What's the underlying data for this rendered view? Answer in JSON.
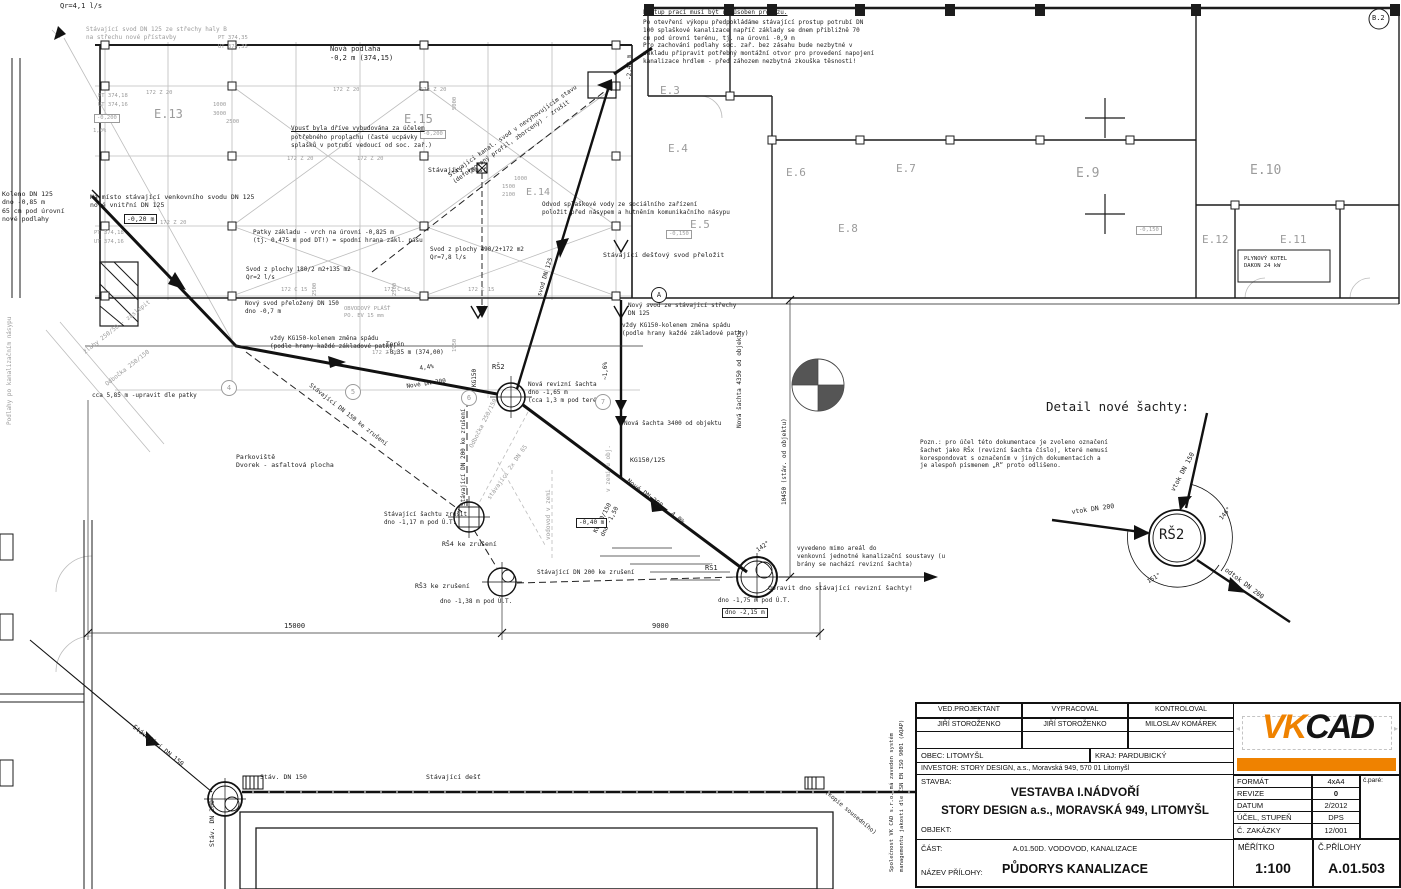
{
  "colors": {
    "ink": "#1c1c1c",
    "gray_line": "#bdbdbd",
    "gray_text": "#9b9b9b",
    "accent_orange": "#ef8200"
  },
  "title_block": {
    "col1_header": "VED.PROJEKTANT",
    "col1_value": "JIŘÍ STOROŽENKO",
    "col2_header": "VYPRACOVAL",
    "col2_value": "JIŘÍ STOROŽENKO",
    "col3_header": "KONTROLOVAL",
    "col3_value": "MILOSLAV KOMÁREK",
    "obec": "OBEC: LITOMYŠL",
    "kraj": "KRAJ: PARDUBICKÝ",
    "investor": "INVESTOR: STORY DESIGN, a.s., Moravská 949, 570 01 Litomyšl",
    "stavba_label": "STAVBA:",
    "stavba_line1": "VESTAVBA I.NÁDVOŘÍ",
    "stavba_line2": "STORY DESIGN a.s., MORAVSKÁ 949, LITOMYŠL",
    "objekt_label": "OBJEKT:",
    "cast_label": "ČÁST:",
    "cast_value": "A.01.50D. VODOVOD, KANALIZACE",
    "nazev_label": "NÁZEV PŘÍLOHY:",
    "nazev_value": "PŮDORYS KANALIZACE",
    "rows": [
      {
        "label": "FORMÁT",
        "value": "4xA4"
      },
      {
        "label": "REVIZE",
        "value": "0"
      },
      {
        "label": "DATUM",
        "value": "2/2012"
      },
      {
        "label": "ÚČEL, STUPEŇ",
        "value": "DPS"
      },
      {
        "label": "Č. ZAKÁZKY",
        "value": "12/001"
      }
    ],
    "pare_label": "č.paré:",
    "meritko_label": "MĚŘÍTKO",
    "meritko_value": "1:100",
    "priloha_label": "Č.PŘÍLOHY",
    "priloha_value": "A.01.503",
    "logo_vk": "VK",
    "logo_cad": "CAD"
  },
  "labels": [
    {
      "t": "Qr=4,1 l/s",
      "x": 60,
      "y": 2,
      "s": 7
    },
    {
      "t": "Stávající svod DN 125 ze střechy haly B\nna střechu nové přístavby",
      "x": 86,
      "y": 26,
      "c": "g",
      "s": 6
    },
    {
      "t": "PT 374,35",
      "x": 218,
      "y": 35,
      "c": "g",
      "s": 5.5
    },
    {
      "t": "UT 374,35",
      "x": 218,
      "y": 44,
      "c": "g",
      "s": 5.5
    },
    {
      "t": "172 Z 20",
      "x": 333,
      "y": 87,
      "c": "g",
      "s": 5.5
    },
    {
      "t": "172 Z 20",
      "x": 420,
      "y": 87,
      "c": "g",
      "s": 5.5
    },
    {
      "t": "172 Z 20",
      "x": 287,
      "y": 156,
      "c": "g",
      "s": 5.5
    },
    {
      "t": "172 Z 20",
      "x": 357,
      "y": 156,
      "c": "g",
      "s": 5.5
    },
    {
      "t": "172 Z 20",
      "x": 160,
      "y": 220,
      "c": "g",
      "s": 5.5
    },
    {
      "t": "172 Z 20",
      "x": 372,
      "y": 350,
      "c": "g",
      "s": 5.5
    },
    {
      "t": "172 Z 20",
      "x": 146,
      "y": 90,
      "c": "g",
      "s": 5.5
    },
    {
      "t": "PT 374,18",
      "x": 98,
      "y": 93,
      "c": "g",
      "s": 5.5
    },
    {
      "t": "UT 374,16",
      "x": 98,
      "y": 102,
      "c": "g",
      "s": 5.5
    },
    {
      "t": "E.13",
      "x": 154,
      "y": 107,
      "c": "g",
      "s": 12,
      "n": "room-label-e13"
    },
    {
      "t": "-0,200",
      "x": 94,
      "y": 114,
      "c": "g",
      "box": 1,
      "s": 5.5
    },
    {
      "t": "1,0%",
      "x": 93,
      "y": 128,
      "c": "g",
      "s": 5.5
    },
    {
      "t": "1000",
      "x": 213,
      "y": 102,
      "c": "g",
      "s": 5.5
    },
    {
      "t": "3000",
      "x": 213,
      "y": 111,
      "c": "g",
      "s": 5.5
    },
    {
      "t": "2500",
      "x": 226,
      "y": 119,
      "c": "g",
      "s": 5.5
    },
    {
      "t": "Nová podlaha\n-0,2 m (374,15)",
      "x": 330,
      "y": 45,
      "s": 7
    },
    {
      "t": "E.15",
      "x": 404,
      "y": 112,
      "c": "g",
      "s": 12,
      "n": "room-label-e15"
    },
    {
      "t": "-0,200",
      "x": 420,
      "y": 130,
      "c": "g",
      "box": 1,
      "s": 5.5
    },
    {
      "t": "5000",
      "x": 452,
      "y": 110,
      "c": "g",
      "s": 5.5,
      "r": -90
    },
    {
      "t": "Vpusť byla dříve vybudována za účelem",
      "x": 291,
      "y": 125,
      "u": 1,
      "s": 6
    },
    {
      "t": "potřebného proplachu (časté ucpávky\nsplašků v potrubí vedoucí od soc. zař.)",
      "x": 291,
      "y": 134,
      "s": 6
    },
    {
      "t": "Stávající vpusť",
      "x": 428,
      "y": 166,
      "s": 6.5
    },
    {
      "t": "Stávající kanal. svod v nevyhovujícím stavu\n(deformovaný profil, zborcený) - zrušit",
      "x": 447,
      "y": 173,
      "r": -35,
      "s": 6
    },
    {
      "t": "1000",
      "x": 514,
      "y": 176,
      "c": "g",
      "s": 5.5
    },
    {
      "t": "1500",
      "x": 502,
      "y": 184,
      "c": "g",
      "s": 5.5
    },
    {
      "t": "2100",
      "x": 502,
      "y": 192,
      "c": "g",
      "s": 5.5
    },
    {
      "t": "E.14",
      "x": 526,
      "y": 186,
      "c": "g",
      "s": 10,
      "n": "room-label-e14"
    },
    {
      "t": "-2,43 m",
      "x": 626,
      "y": 80,
      "r": -90,
      "s": 6
    },
    {
      "t": "Postup prací musí být uzpůsoben provozu.",
      "x": 643,
      "y": 9,
      "u": 1,
      "s": 6,
      "n": "note-postup-title"
    },
    {
      "t": "Po otevření výkopu předpokládáme stávající prostup potrubí DN\n100 splaškové kanalizace napříč základy se dnem přibližně 70\ncm pod úrovní terénu, tj. na úrovni -0,9 m\nPro zachování podlahy soc. zař. bez zásahu bude nezbytné v\nzákladu připravit potřebný montážní otvor pro provedení napojení\nkanalizace hrdlem - před záhozem nezbytná zkouška těsnosti!",
      "x": 643,
      "y": 19,
      "s": 6,
      "n": "note-postup-body"
    },
    {
      "t": "E.3",
      "x": 660,
      "y": 84,
      "c": "g",
      "s": 11,
      "n": "room-label-e3"
    },
    {
      "t": "E.4",
      "x": 668,
      "y": 142,
      "c": "g",
      "s": 11,
      "n": "room-label-e4"
    },
    {
      "t": "E.5",
      "x": 690,
      "y": 218,
      "c": "g",
      "s": 11,
      "n": "room-label-e5"
    },
    {
      "t": "E.6",
      "x": 786,
      "y": 166,
      "c": "g",
      "s": 11,
      "n": "room-label-e6"
    },
    {
      "t": "E.7",
      "x": 896,
      "y": 162,
      "c": "g",
      "s": 11,
      "n": "room-label-e7"
    },
    {
      "t": "E.8",
      "x": 838,
      "y": 222,
      "c": "g",
      "s": 11,
      "n": "room-label-e8"
    },
    {
      "t": "E.9",
      "x": 1076,
      "y": 166,
      "c": "g",
      "s": 13,
      "n": "room-label-e9"
    },
    {
      "t": "E.10",
      "x": 1250,
      "y": 163,
      "c": "g",
      "s": 13,
      "n": "room-label-e10"
    },
    {
      "t": "E.12",
      "x": 1202,
      "y": 233,
      "c": "g",
      "s": 11,
      "n": "room-label-e12"
    },
    {
      "t": "E.11",
      "x": 1280,
      "y": 233,
      "c": "g",
      "s": 11,
      "n": "room-label-e11"
    },
    {
      "t": "-0,150",
      "x": 666,
      "y": 230,
      "c": "g",
      "box": 1,
      "s": 5.5
    },
    {
      "t": "-0,150",
      "x": 1136,
      "y": 226,
      "c": "g",
      "box": 1,
      "s": 5.5
    },
    {
      "t": "PLYNOVÝ KOTEL\nDAKON 24 kW",
      "x": 1244,
      "y": 256,
      "s": 5.5
    },
    {
      "t": "B.2",
      "x": 1372,
      "y": 14,
      "s": 7,
      "n": "grid-label-b2"
    },
    {
      "t": "Odvod splaškové vody ze sociálního zařízení\npoložit před násypem a hutněním komunikačního násypu",
      "x": 542,
      "y": 201,
      "s": 6
    },
    {
      "t": "Stávající dešťový svod přeložit",
      "x": 603,
      "y": 251,
      "s": 6.5
    },
    {
      "t": "Svod z plochy 490/2+172 m2\nQr=7,8 l/s",
      "x": 430,
      "y": 246,
      "s": 6
    },
    {
      "t": "svod DN 125",
      "x": 536,
      "y": 295,
      "r": -73,
      "s": 6
    },
    {
      "t": "Patky základu - vrch na úrovni -0,825 m\n(tj. 0,475 m pod DT!) = spodní hrana zákl. pásu",
      "x": 253,
      "y": 229,
      "s": 6
    },
    {
      "t": "Svod z plochy 180/2 m2+135 m2\nQr=2 l/s",
      "x": 246,
      "y": 266,
      "s": 6
    },
    {
      "t": "Nový svod přeložený DN 150\ndno -0,7 m",
      "x": 245,
      "y": 300,
      "s": 6
    },
    {
      "t": "OBVODOVÝ PLÁŠŤ\nPO. EV 15 mm",
      "x": 344,
      "y": 306,
      "c": "g",
      "s": 5.5
    },
    {
      "t": "vždy KG150-kolenem změna spádu\n(podle hrany každé základové patky)",
      "x": 270,
      "y": 335,
      "s": 6
    },
    {
      "t": "Terén\n-0,35 m (374,00)",
      "x": 386,
      "y": 341,
      "s": 6
    },
    {
      "t": "4,4%",
      "x": 419,
      "y": 365,
      "r": -8,
      "s": 6
    },
    {
      "t": "Nové DN 200",
      "x": 406,
      "y": 383,
      "r": -8,
      "s": 6
    },
    {
      "t": "KG150",
      "x": 471,
      "y": 387,
      "r": -90,
      "s": 6
    },
    {
      "t": "RŠ2",
      "x": 492,
      "y": 363,
      "s": 7,
      "n": "manhole-label-rs2"
    },
    {
      "t": "Nová revizní šachta\ndno -1,65 m\n(cca 1,3 m pod terénem)",
      "x": 528,
      "y": 381,
      "s": 6
    },
    {
      "t": "Nová šachta 3400 od objektu",
      "x": 624,
      "y": 420,
      "s": 6
    },
    {
      "t": "~1,6%",
      "x": 602,
      "y": 380,
      "r": -90,
      "s": 6
    },
    {
      "t": "vždy KG150-kolenem změna spádu\n(podle hrany každé základové patky)",
      "x": 622,
      "y": 322,
      "s": 6
    },
    {
      "t": "Nový svod ze stávající střechy\nDN 125",
      "x": 628,
      "y": 302,
      "s": 6
    },
    {
      "t": "Nová šachta 4350 od objektu",
      "x": 736,
      "y": 428,
      "r": -90,
      "s": 6
    },
    {
      "t": "10450 (stáv. od objektu)",
      "x": 781,
      "y": 505,
      "r": -90,
      "s": 6
    },
    {
      "t": "KG150/125",
      "x": 630,
      "y": 456,
      "s": 6.5
    },
    {
      "t": "KG200/150\ndno -1,50",
      "x": 592,
      "y": 531,
      "r": -63,
      "s": 6
    },
    {
      "t": "Nové DN 200 - 4,0%",
      "x": 630,
      "y": 477,
      "r": 37,
      "s": 6.5
    },
    {
      "t": "-0,40 m",
      "x": 576,
      "y": 518,
      "box": 1,
      "s": 6
    },
    {
      "t": "vyvedeno mimo areál do\nvenkovní jednotné kanalizační soustavy (u\nbrány se nachází revizní šachta)",
      "x": 797,
      "y": 545,
      "s": 6
    },
    {
      "t": "RŠ1",
      "x": 705,
      "y": 564,
      "s": 7,
      "n": "manhole-label-rs1"
    },
    {
      "t": "142°",
      "x": 755,
      "y": 548,
      "r": -35,
      "s": 6
    },
    {
      "t": "Opravit dno stávající revizní šachty!",
      "x": 768,
      "y": 584,
      "s": 6.5
    },
    {
      "t": "dno -1,75 m pod Ú.T.",
      "x": 718,
      "y": 597,
      "s": 6
    },
    {
      "t": "dno -2,15 m",
      "x": 722,
      "y": 608,
      "box": 1,
      "s": 6
    },
    {
      "t": "Stávající šachtu zrušit\ndno -1,17 m pod Ú.T.",
      "x": 384,
      "y": 511,
      "s": 6
    },
    {
      "t": "RŠ4 ke zrušení",
      "x": 442,
      "y": 540,
      "s": 6.5,
      "n": "manhole-label-rs4"
    },
    {
      "t": "RŠ3 ke zrušení",
      "x": 415,
      "y": 582,
      "s": 6.5,
      "n": "manhole-label-rs3"
    },
    {
      "t": "dno -1,38 m pod Ú.T.",
      "x": 440,
      "y": 598,
      "s": 6
    },
    {
      "t": "Stávající DN 200 ke zrušení",
      "x": 537,
      "y": 569,
      "s": 6
    },
    {
      "t": "Stávající DN 150 ke zrušení",
      "x": 312,
      "y": 382,
      "r": 38,
      "s": 6
    },
    {
      "t": "Stávající DN 200 ke zrušení",
      "x": 460,
      "y": 506,
      "r": -90,
      "s": 6
    },
    {
      "t": "Odbočka 250/150",
      "x": 468,
      "y": 446,
      "r": -63,
      "c": "g",
      "s": 6
    },
    {
      "t": "stávající 2x DN 65",
      "x": 486,
      "y": 497,
      "r": -55,
      "c": "g",
      "s": 6
    },
    {
      "t": "vodovod v zemi",
      "x": 545,
      "y": 540,
      "r": -90,
      "c": "g",
      "s": 6
    },
    {
      "t": "v zemi u obj.",
      "x": 605,
      "y": 492,
      "r": -90,
      "c": "g",
      "s": 6
    },
    {
      "t": "Parkoviště\nDvorek - asfaltová plocha",
      "x": 236,
      "y": 453,
      "s": 6.5
    },
    {
      "t": "15000",
      "x": 284,
      "y": 622,
      "s": 7
    },
    {
      "t": "9000",
      "x": 652,
      "y": 622,
      "s": 7
    },
    {
      "t": "cca 5,85 m -upravit dle patky",
      "x": 92,
      "y": 392,
      "s": 6
    },
    {
      "t": "žlaby 250/50 - zaslepit",
      "x": 82,
      "y": 350,
      "r": -38,
      "c": "g",
      "s": 6
    },
    {
      "t": "Odbočka 250/150",
      "x": 104,
      "y": 382,
      "r": -38,
      "c": "g",
      "s": 6
    },
    {
      "t": "Podlahy po kanalizačním násypu",
      "x": 6,
      "y": 425,
      "r": -90,
      "c": "g",
      "s": 6
    },
    {
      "t": "Koleno DN 125\ndno -0,85 m\n65 cm pod úrovní\nnové podlahy",
      "x": 2,
      "y": 190,
      "s": 6.5
    },
    {
      "t": "Na místo stávající venkovního svodu DN 125\nnové vnitřní DN 125",
      "x": 90,
      "y": 193,
      "s": 6.5
    },
    {
      "t": "-0,20 m",
      "x": 124,
      "y": 214,
      "box": 1,
      "s": 6.5
    },
    {
      "t": "PT 374,18",
      "x": 94,
      "y": 230,
      "c": "g",
      "s": 5.5
    },
    {
      "t": "UT 374,16",
      "x": 94,
      "y": 239,
      "c": "g",
      "s": 5.5
    },
    {
      "t": "Stávající DN 150",
      "x": 136,
      "y": 723,
      "r": 38,
      "s": 6.5
    },
    {
      "t": "Stáv. DN 150",
      "x": 260,
      "y": 773,
      "s": 6.5
    },
    {
      "t": "Stáv. DN 200",
      "x": 208,
      "y": 847,
      "r": -90,
      "s": 6.5
    },
    {
      "t": "Stávající dešť",
      "x": 426,
      "y": 773,
      "s": 6.5
    },
    {
      "t": "(kopie sousedního)",
      "x": 828,
      "y": 789,
      "r": 40,
      "s": 6
    },
    {
      "t": "Společnost VK CAD s.r.o. má zaveden systém",
      "x": 889,
      "y": 872,
      "r": -90,
      "s": 5.5
    },
    {
      "t": "managementu jakosti dle ČSN EN ISO 9001 (AQAP)",
      "x": 899,
      "y": 872,
      "r": -90,
      "s": 5.5
    },
    {
      "t": "Detail nové šachty:",
      "x": 1046,
      "y": 399,
      "s": 12.5,
      "n": "detail-title"
    },
    {
      "t": "Pozn.: pro účel této dokumentace je zvoleno označení\nšachet jako RŠx (revizní šachta číslo), které nemusí\nkorespondovat s označením v jiných dokumentacích a\nje alespoň písmenem „R“ proto odlišeno.",
      "x": 920,
      "y": 439,
      "s": 6,
      "n": "detail-note"
    },
    {
      "t": "RŠ2",
      "x": 1159,
      "y": 526,
      "s": 14,
      "n": "detail-shaft-label"
    },
    {
      "t": "vtok DN 150",
      "x": 1169,
      "y": 489,
      "r": -62,
      "s": 6.5
    },
    {
      "t": "vtok DN 200",
      "x": 1071,
      "y": 508,
      "r": -8,
      "s": 6.5
    },
    {
      "t": "odtok DN 200",
      "x": 1228,
      "y": 566,
      "r": 37,
      "s": 6.5
    },
    {
      "t": "146°",
      "x": 1218,
      "y": 517,
      "r": -50,
      "s": 6
    },
    {
      "t": "151°",
      "x": 1146,
      "y": 579,
      "r": -30,
      "s": 6
    },
    {
      "t": "4",
      "x": 221,
      "y": 380,
      "bub": 1,
      "c": "g",
      "n": "grid-bubble-4"
    },
    {
      "t": "5",
      "x": 345,
      "y": 384,
      "bub": 1,
      "c": "g",
      "n": "grid-bubble-5"
    },
    {
      "t": "6",
      "x": 461,
      "y": 390,
      "bub": 1,
      "c": "g",
      "n": "grid-bubble-6"
    },
    {
      "t": "7",
      "x": 595,
      "y": 394,
      "bub": 1,
      "c": "g",
      "n": "grid-bubble-7"
    },
    {
      "t": "A",
      "x": 651,
      "y": 287,
      "bub": 1,
      "n": "grid-bubble-a"
    },
    {
      "t": "1950",
      "x": 452,
      "y": 352,
      "r": -90,
      "c": "g",
      "s": 5.5
    },
    {
      "t": "172 C 15",
      "x": 281,
      "y": 287,
      "c": "g",
      "s": 5.5
    },
    {
      "t": "172 C 15",
      "x": 384,
      "y": 287,
      "c": "g",
      "s": 5.5
    },
    {
      "t": "172 C 15",
      "x": 468,
      "y": 287,
      "c": "g",
      "s": 5.5
    },
    {
      "t": "2500",
      "x": 312,
      "y": 296,
      "r": -90,
      "c": "g",
      "s": 5.5
    },
    {
      "t": "2500",
      "x": 392,
      "y": 296,
      "r": -90,
      "c": "g",
      "s": 5.5
    }
  ]
}
